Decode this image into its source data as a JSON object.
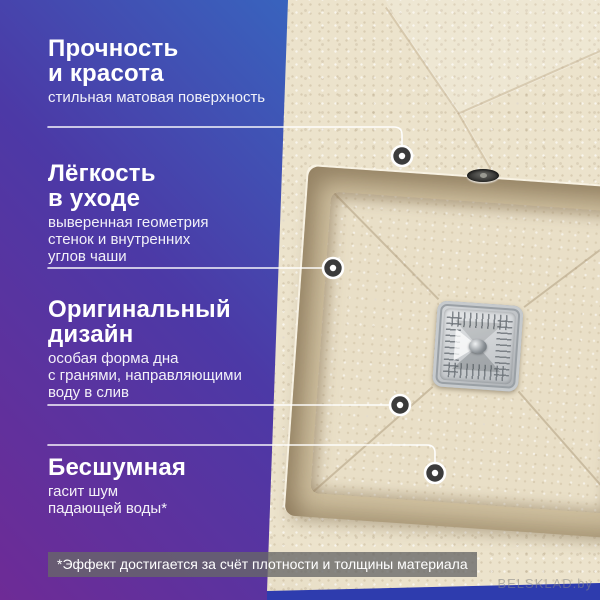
{
  "meta": {
    "language": "ru",
    "kind": "product-feature-infographic"
  },
  "colors": {
    "gradient_purple": "#6e2b96",
    "gradient_indigo": "#4c39a6",
    "gradient_blue": "#2a82cf",
    "gradient_deep_blue": "#2e3cae",
    "sink_beige": "#ece3cc",
    "sink_wall": "#d3c4a3",
    "sink_floor": "#e9dfc7",
    "drain_metal": "#c3c7cb",
    "text_white": "#ffffff"
  },
  "icons": {
    "callout_dot": "ring-dot-marker",
    "drain": "square-drain-cover",
    "hole": "overflow-hole"
  },
  "features": [
    {
      "title_lines": [
        "Прочность",
        "и красота"
      ],
      "desc_lines": [
        "стильная матовая поверхность"
      ]
    },
    {
      "title_lines": [
        "Лёгкость",
        "в уходе"
      ],
      "desc_lines": [
        "выверенная геометрия",
        "стенок и внутренних",
        "углов чаши"
      ]
    },
    {
      "title_lines": [
        "Оригинальный",
        "дизайн"
      ],
      "desc_lines": [
        "особая форма дна",
        "с гранями, направляющими",
        "воду в слив"
      ]
    },
    {
      "title_lines": [
        "Бесшумная"
      ],
      "desc_lines": [
        "гасит шум",
        "падающей воды*"
      ]
    }
  ],
  "footnote": "*Эффект достигается за счёт плотности и толщины материала",
  "watermark": "BELSKLAD.by"
}
